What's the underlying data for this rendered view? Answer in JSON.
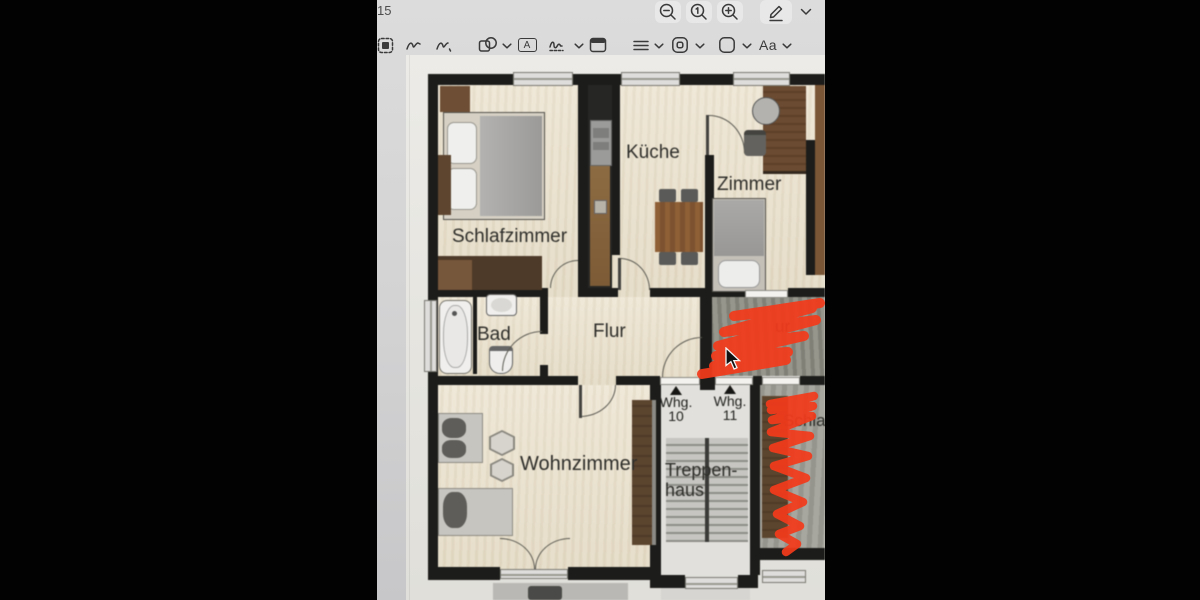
{
  "window": {
    "page_number": "15"
  },
  "toolbar": {
    "text_tool_glyph": "A",
    "text_style_label": "Aa"
  },
  "floorplan": {
    "labels": {
      "schlafzimmer": "Schlafzimmer",
      "kueche": "Küche",
      "zimmer": "Zimmer",
      "bad": "Bad",
      "flur": "Flur",
      "wohnzimmer": "Wohnzimmer",
      "treppenhaus_line1": "Treppen-",
      "treppenhaus_line2": "haus",
      "unit10_label": "Whg.",
      "unit10_number": "10",
      "unit11_label": "Whg.",
      "unit11_number": "11",
      "neighbor_room_partial": "Schla",
      "neighbor_flur_partial": "ur"
    },
    "annotation_color": "#f23a1b"
  },
  "colors": {
    "wall": "#1c1c1a",
    "paper": "#eae8e2",
    "floor_cream": "#ece3d2",
    "app_background": "#d4d4d5",
    "annotation_red": "#f23a1b"
  }
}
